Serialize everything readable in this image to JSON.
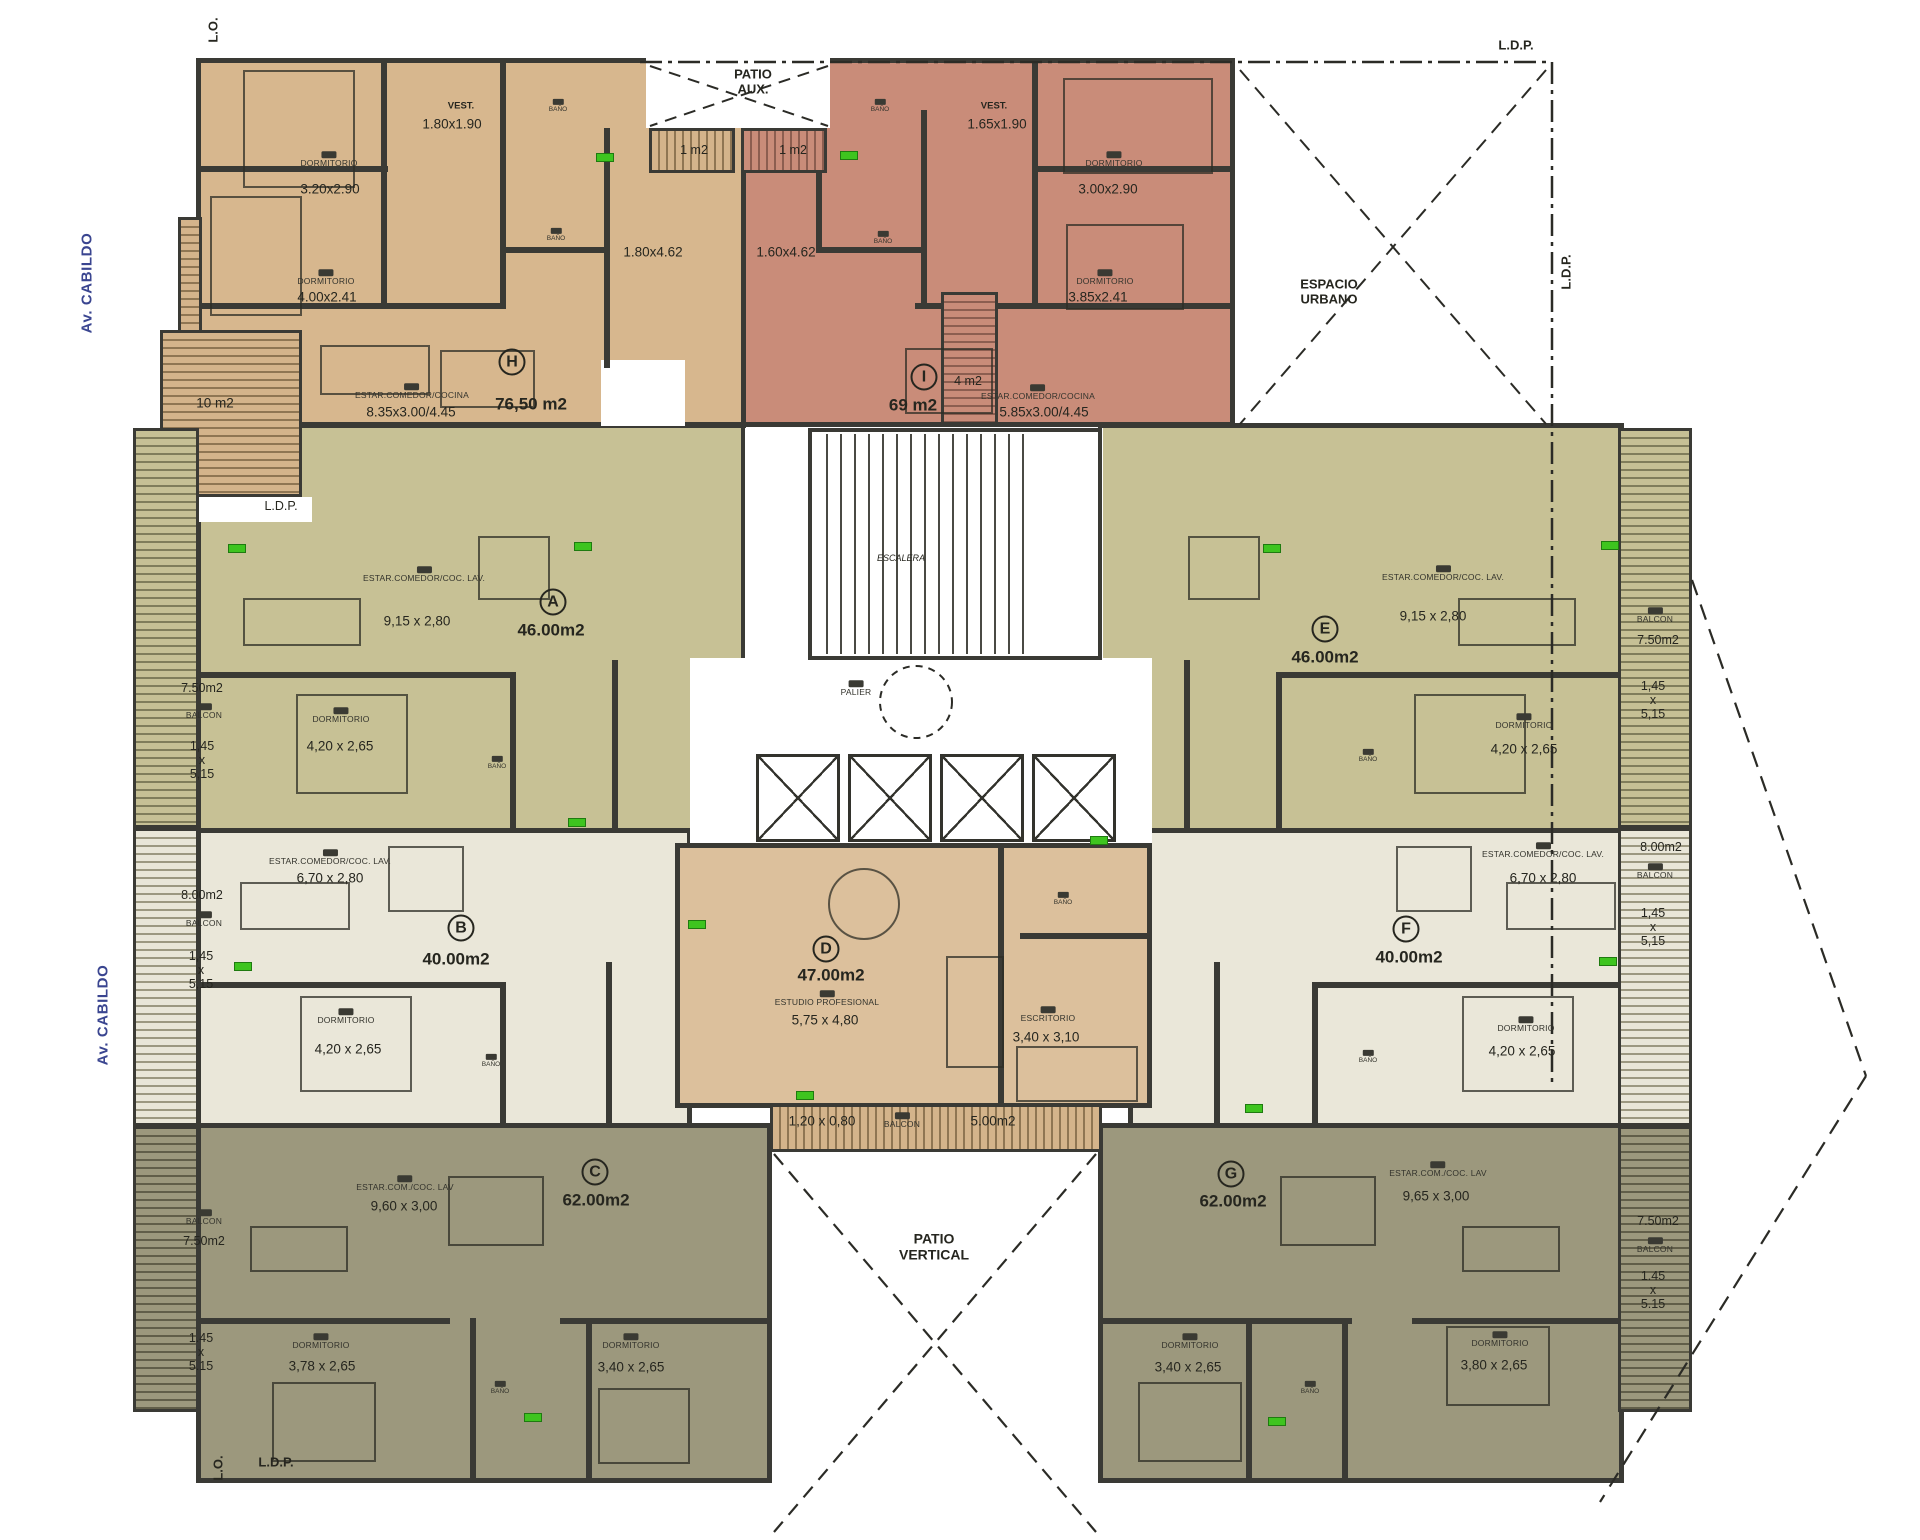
{
  "site": {
    "street_name": "Av. CABILDO",
    "lo_marker": "L.O.",
    "ldp_marker": "L.D.P.",
    "espacio_urbano": "ESPACIO\nURBANO",
    "patio_aux": "PATIO\nAUX.",
    "patio_vertical": "PATIO\nVERTICAL"
  },
  "core": {
    "stairs_label": "ESCALERA",
    "landing_label": "PALIER",
    "elevator_count": 4
  },
  "room_labels": {
    "bath": "BAÑO",
    "bedroom": "DORMITORIO",
    "balcony": "BALCON"
  },
  "units": {
    "A": {
      "letter": "A",
      "area": "46.00m2",
      "living_label": "ESTAR.COMEDOR/COC. LAV.",
      "living_dim": "9,15 x 2,80",
      "bedroom_dim": "4,20 x 2,65",
      "balcony_area": "7.50m2",
      "balcony_dim": "1,45\nx\n5,15"
    },
    "B": {
      "letter": "B",
      "area": "40.00m2",
      "living_label": "ESTAR.COMEDOR/COC. LAV.",
      "living_dim": "6,70 x 2,80",
      "bedroom_dim": "4,20 x 2,65",
      "balcony_area": "8.00m2",
      "balcony_dim": "1,45\nx\n5,15"
    },
    "C": {
      "letter": "C",
      "area": "62.00m2",
      "living_label": "ESTAR.COM./COC. LAV",
      "living_dim": "9,60 x 3,00",
      "bedroom1_dim": "3,78 x 2,65",
      "bedroom2_dim": "3,40 x 2,65",
      "balcony_area": "7.50m2",
      "balcony_dim": "1.45\nx\n5.15"
    },
    "D": {
      "letter": "D",
      "area": "47.00m2",
      "studio_label": "ESTUDIO PROFESIONAL",
      "studio_dim": "5,75 x 4,80",
      "office_label": "ESCRITORIO",
      "office_dim": "3,40 x 3,10",
      "balcony_area": "5.00m2",
      "balcony_dim": "1,20 x 0,80"
    },
    "E": {
      "letter": "E",
      "area": "46.00m2",
      "living_label": "ESTAR.COMEDOR/COC. LAV.",
      "living_dim": "9,15 x 2,80",
      "bedroom_dim": "4,20 x 2,65",
      "balcony_area": "7.50m2",
      "balcony_dim": "1,45\nx\n5,15"
    },
    "F": {
      "letter": "F",
      "area": "40.00m2",
      "living_label": "ESTAR.COMEDOR/COC. LAV.",
      "living_dim": "6,70 x 2,80",
      "bedroom_dim": "4,20 x 2,65",
      "balcony_area": "8.00m2",
      "balcony_dim": "1,45\nx\n5,15"
    },
    "G": {
      "letter": "G",
      "area": "62.00m2",
      "living_label": "ESTAR.COM./COC. LAV",
      "living_dim": "9,65 x 3,00",
      "bedroom1_dim": "3,40 x 2,65",
      "bedroom2_dim": "3,80 x 2,65",
      "balcony_area": "7.50m2",
      "balcony_dim": "1.45\nx\n5.15"
    },
    "H": {
      "letter": "H",
      "area": "76,50 m2",
      "vest_label": "VEST.",
      "vest_dim": "1.80x1.90",
      "bedroom1_dim": "3.20x2.90",
      "bedroom2_dim": "4.00x2.41",
      "living_label": "ESTAR.COMEDOR/COCINA",
      "living_dim": "8.35x3.00/4.45",
      "kitchen_dim": "1.80x4.62",
      "terrace_area": "10 m2",
      "patio_balcony_area": "1 m2"
    },
    "I": {
      "letter": "I",
      "area": "69 m2",
      "vest_label": "VEST.",
      "vest_dim": "1.65x1.90",
      "bedroom1_dim": "3.00x2.90",
      "bedroom2_dim": "3.85x2.41",
      "living_label": "ESTAR.COMEDOR/COCINA",
      "living_dim": "5.85x3.00/4.45",
      "kitchen_dim": "1.60x4.62",
      "terrace_area": "4 m2",
      "patio_balcony_area": "1 m2"
    }
  },
  "colors": {
    "unit_h_fill": "#d7b78e",
    "unit_i_fill": "#c98c79",
    "unit_ae_fill": "#c7c195",
    "unit_bf_fill": "#eae7d9",
    "unit_cg_fill": "#9c987d",
    "unit_d_fill": "#dcc09c",
    "wall": "#3a3a35",
    "marker_green": "#3ec41f",
    "street_text": "#3a4590"
  }
}
